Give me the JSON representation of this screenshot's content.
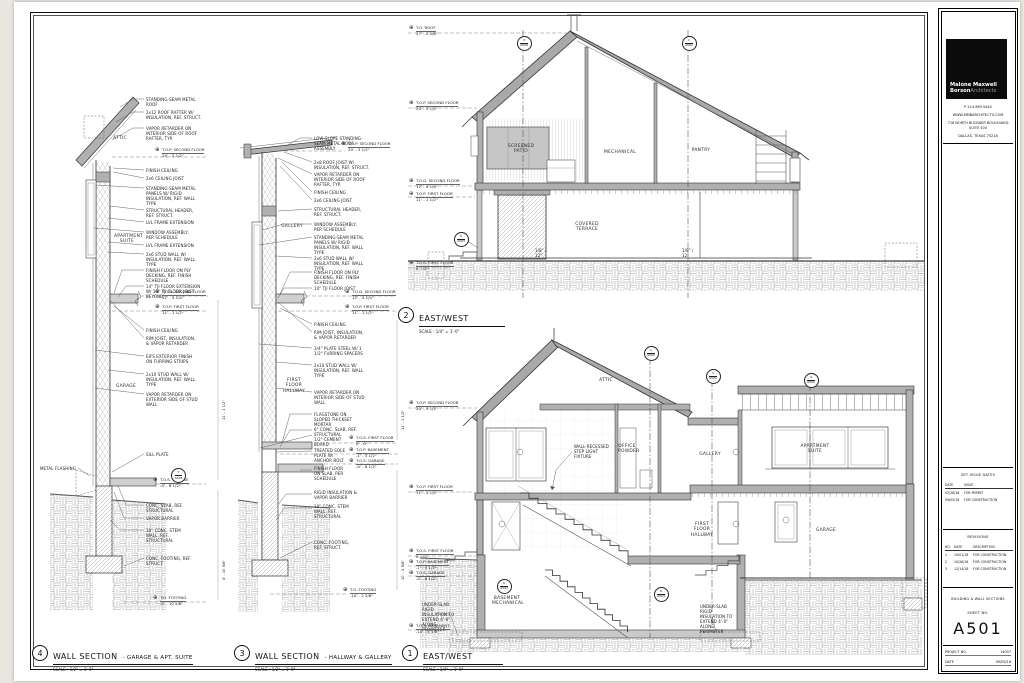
{
  "titleblock": {
    "logo": {
      "line1": "Malone Maxwell",
      "line2_bold": "Borson",
      "line2_light": "Architects"
    },
    "phone": "P  214.969.5440",
    "website": "WWW.MMBARCHITECTS.COM",
    "address_line1": "718 NORTH BUCKNER BOULEVARD",
    "address_line2": "SUITE 400",
    "address_line3": "DALLAS, TEXAS 75218",
    "set_issue": {
      "heading": "SET ISSUE DATES",
      "col_date": "DATE",
      "col_issue": "ISSUE",
      "rows": [
        {
          "date": "02/26/18",
          "issue": "FOR PERMIT"
        },
        {
          "date": "09/05/18",
          "issue": "FOR CONSTRUCTION"
        }
      ]
    },
    "revisions": {
      "heading": "REVISIONS",
      "col_no": "NO.",
      "col_date": "DATE",
      "col_desc": "DESCRIPTION",
      "rows": [
        {
          "no": "1",
          "date": "10/01/18",
          "desc": "FOR CONSTRUCTION"
        },
        {
          "no": "2",
          "date": "10/26/18",
          "desc": "FOR CONSTRUCTION"
        },
        {
          "no": "3",
          "date": "12/14/18",
          "desc": "FOR CONSTRUCTION"
        }
      ]
    },
    "sheet_title": "BUILDING & WALL SECTIONS",
    "sheet_no_label": "SHEET NO.",
    "sheet_no": "A501",
    "project_label": "PROJECT NO.",
    "project_no": "14007",
    "date_label": "DATE",
    "date_value": "09/05/18"
  },
  "icons": {
    "level_marker": "⊕"
  },
  "titles": {
    "d4": {
      "num": "4",
      "main": "WALL SECTION",
      "sub": "- GARAGE & APT. SUITE",
      "scale": "SCALE : 1/2\" = 1'-0\""
    },
    "d3": {
      "num": "3",
      "main": "WALL SECTION",
      "sub": "- HALLWAY & GALLERY",
      "scale": "SCALE : 1/2\" = 1'-0\""
    },
    "d2": {
      "num": "2",
      "main": "EAST/WEST",
      "sub": "",
      "scale": "SCALE : 1/4\" = 1'-0\""
    },
    "d1": {
      "num": "1",
      "main": "EAST/WEST",
      "sub": "",
      "scale": "SCALE : 1/4\" = 1'-0\""
    }
  },
  "d4": {
    "notes": [
      "STANDING-SEAM METAL ROOF",
      "2x12 ROOF RAFTER W/ INSULATION, REF. STRUCT.",
      "VAPOR RETARDER ON INTERIOR SIDE OF ROOF RAFTER, TYP.",
      "FINISH CEILING",
      "2x6 CEILING JOIST",
      "STANDING-SEAM METAL PANELS W/ RIGID INSULATION, REF. WALL TYPE",
      "STRUCTURAL HEADER, REF. STRUCT.",
      "LVL FRAME EXTENSION",
      "WINDOW ASSEMBLY, PER SCHEDULE",
      "LVL FRAME EXTENSION",
      "2x6 STUD WALL W/ INSULATION, REF. WALL TYPE",
      "FINISH FLOOR ON PLY DECKING, REF. FINISH SCHEDULE",
      "14\" TJI FLOOR EXTENSION W/ 16\" TJI FLOOR JOIST BEYOND",
      "FINISH CEILING",
      "RIM JOIST, INSULATION, & VAPOR RETARDER",
      "EIFS EXTERIOR FINISH ON FURRING STRIPS",
      "2x10 STUD WALL W/ INSULATION, REF. WALL TYPE",
      "VAPOR RETARDER ON EXTERIOR SIDE OF STUD WALL",
      "SILL PLATE",
      "METAL FLASHING",
      "CONC. SLAB, REF. STRUCTURAL",
      "VAPOR BARRIER",
      "10\" CONC. STEM WALL, REF. STRUCTURAL",
      "CONC. FOOTING, REF. STRUCT."
    ],
    "rooms": {
      "attic": "ATTIC",
      "apartment": "APARTMENT SUITE",
      "garage": "GARAGE"
    },
    "levels": [
      {
        "n": "T.O.P. SECOND FLOOR",
        "v": "20' - 3 1/2\""
      },
      {
        "n": "T.O.D. SECOND FLOOR",
        "v": "12' - 4 1/4\""
      },
      {
        "n": "T.O.P. FIRST FLOOR",
        "v": "11' - 1 1/2\""
      },
      {
        "n": "T.O.S. GARAGE",
        "v": "-0' - 6 1/2\""
      },
      {
        "n": "T.O. FOOTING",
        "v": "-4' - 10 5/8\""
      }
    ],
    "dims": [
      "11' - 1 1/2\"",
      "4' - 10 5/8\""
    ]
  },
  "d3": {
    "notes": [
      "LOW-SLOPE STANDING-SEAM METAL ROOF ASSEMBLY",
      "2x8 ROOF JOIST W/ INSULATION, REF. STRUCT.",
      "VAPOR RETARDER ON INTERIOR SIDE OF ROOF RAFTER, TYP.",
      "FINISH CEILING",
      "2x6 CEILING JOIST",
      "STRUCTURAL HEADER, REF. STRUCT.",
      "WINDOW ASSEMBLY, PER SCHEDULE",
      "STANDING-SEAM METAL PANELS W/ RIGID INSULATION, REF. WALL TYPE",
      "2x6 STUD WALL W/ INSULATION, REF. WALL TYPE",
      "FINISH FLOOR ON PLY DECKING, REF. FINISH SCHEDULE",
      "14\" TJI FLOOR JOIST",
      "FINISH CEILING",
      "RIM JOIST, INSULATION, & VAPOR RETARDER",
      "3/4\" PLATE STEEL W/ 1 1/2\" FURRING SPACERS",
      "2x10 STUD WALL W/ INSULATION, REF. WALL TYPE",
      "VAPOR RETARDER ON INTERIOR SIDE OF STUD WALL",
      "FLAGSTONE ON SLOPED THICKSET MORTAR",
      "6\" CONC. SLAB, REF. STRUCTURAL",
      "1/2\" CEMENT BOARD",
      "TREATED SOLE PLATE W/ ANCHOR BOLT",
      "FINISH FLOOR ON SLAB, PER SCHEDULE",
      "RIGID INSULATION & VAPOR BARRIER",
      "10\" CONC. STEM WALL, REF. STRUCTURAL",
      "CONC. FOOTING, REF. STRUCT."
    ],
    "rooms": {
      "gallery": "GALLERY",
      "hallway": "FIRST FLOOR HALLWAY"
    },
    "levels": [
      {
        "n": "T.O.P. SECOND FLOOR",
        "v": "20' - 3 1/2\""
      },
      {
        "n": "T.O.D. SECOND FLOOR",
        "v": "12' - 4 1/4\""
      },
      {
        "n": "T.O.P. FIRST FLOOR",
        "v": "11' - 1 1/2\""
      },
      {
        "n": "T.O.S. FIRST FLOOR",
        "v": "0' - 0\""
      },
      {
        "n": "T.O.P. BASEMENT",
        "v": "-1' - 3 1/2\""
      },
      {
        "n": "T.O.S. GARAGE",
        "v": "-0' - 6 1/2\""
      },
      {
        "n": "T.O. FOOTING",
        "v": "-10' - 2 5/8\""
      }
    ],
    "dims": [
      "11' - 1 1/2\"",
      "10' - 2 5/8\""
    ]
  },
  "d2": {
    "levels": [
      {
        "n": "T.O. ROOF",
        "v": "27' - 2 5/8\""
      },
      {
        "n": "T.O.P. SECOND FLOOR",
        "v": "20' - 3 1/2\""
      },
      {
        "n": "T.O.D. SECOND FLOOR",
        "v": "12' - 4 1/4\""
      },
      {
        "n": "T.O.P. FIRST FLOOR",
        "v": "11' - 1 1/2\""
      },
      {
        "n": "T.O.S. FIRST FLOOR",
        "v": "0' - 0\""
      }
    ],
    "rooms": {
      "patio": "SCREENED PATIO",
      "mech": "MECHANICAL",
      "pantry": "PANTRY",
      "terrace": "COVERED TERRACE"
    },
    "slope": "1/8\" / 12\""
  },
  "d1": {
    "levels": [
      {
        "n": "T.O.P. SECOND FLOOR",
        "v": "20' - 3 1/2\""
      },
      {
        "n": "T.O.P. FIRST FLOOR",
        "v": "11' - 1 1/2\""
      },
      {
        "n": "T.O.S. FIRST FLOOR",
        "v": "0' - 0\""
      },
      {
        "n": "T.O.P. BASEMENT",
        "v": "-1' - 3 1/2\""
      },
      {
        "n": "T.O.S. GARAGE",
        "v": "-0' - 6 1/2\""
      },
      {
        "n": "T.O.S. BASEMENT",
        "v": "-10' - 4 5/8\""
      }
    ],
    "rooms": {
      "attic": "ATTIC",
      "office": "OFFICE POWDER",
      "gallery": "GALLERY",
      "apartment": "APARTMENT SUITE",
      "hallway": "FIRST FLOOR HALLWAY",
      "garage": "GARAGE",
      "basement": "BASEMENT MECHANICAL"
    },
    "notes": [
      "WALL-RECESSED STEP LIGHT FIXTURE",
      "UNDER-SLAB RIGID INSULATION TO EXTEND 4'-0\" ALONG PERIMETER"
    ]
  },
  "markers": {
    "d2a": {
      "num": "3",
      "sheet": "A509"
    },
    "d2b": {
      "num": "1",
      "sheet": "A502"
    },
    "d2c": {
      "num": "5",
      "sheet": "A503"
    },
    "d1a": {
      "num": "1",
      "sheet": "A502"
    },
    "d1b": {
      "num": "3",
      "sheet": "A501"
    },
    "d1c": {
      "num": "4",
      "sheet": "A501"
    },
    "d1d": {
      "num": "6",
      "sheet": "A503"
    },
    "d1e": {
      "num": "8",
      "sheet": "A503"
    },
    "d4a": {
      "num": "7",
      "sheet": "A503"
    }
  }
}
